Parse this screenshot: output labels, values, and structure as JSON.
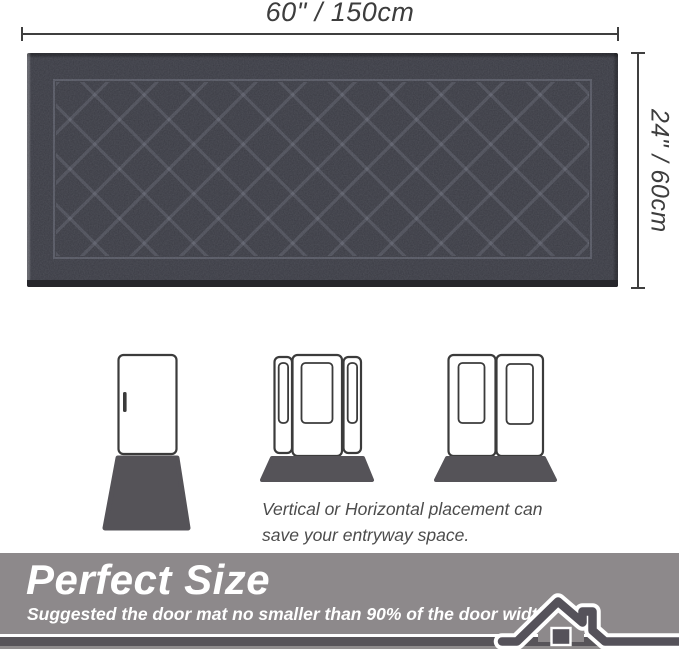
{
  "dimensions": {
    "width_label": "60\" / 150cm",
    "height_label": "24\" / 60cm",
    "line_color": "#3f3f3f",
    "label_color": "#3d3d3d"
  },
  "mat": {
    "description": "dark charcoal quilted door mat with diamond lattice pattern",
    "base_color": "#3a3b43",
    "pattern_line_color": "rgba(200,205,225,0.13)",
    "bottom_edge_color": "#26262b"
  },
  "placement": {
    "diagrams": [
      {
        "name": "single-door-vertical-mat"
      },
      {
        "name": "door-with-sidelights-horizontal-mat"
      },
      {
        "name": "double-door-horizontal-mat"
      }
    ],
    "door_stroke_color": "#3b3b3b",
    "mat_color": "#555358",
    "caption_line1": "Vertical or Horizontal placement can",
    "caption_line2": "save your entryway space.",
    "caption_color": "#4c4c4c"
  },
  "banner": {
    "title": "Perfect Size",
    "subtitle": "Suggested the door mat no smaller than 90% of the door width.",
    "bg_color": "#8d898b",
    "text_color": "#ffffff",
    "bar_color": "#575459",
    "house_icon_color": "#55525a"
  }
}
